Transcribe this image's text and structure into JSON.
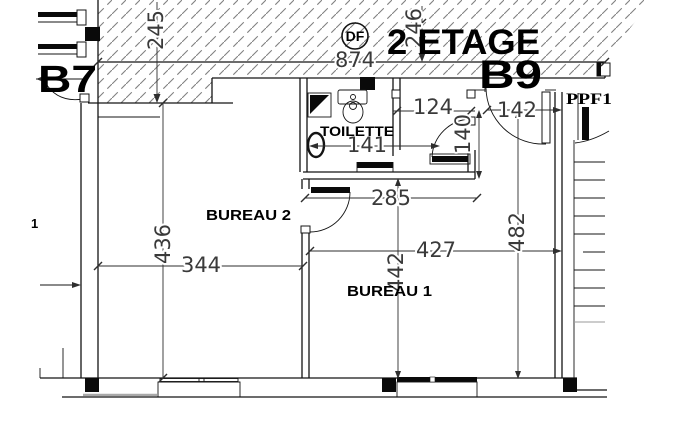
{
  "drawing": {
    "floor_title": "2 ETAGE",
    "zone_left": "B7",
    "zone_right": "B9",
    "smoke_detector": "DF",
    "door_code": "PPF1",
    "marker": "1",
    "rooms": {
      "toilette": "TOILETTE",
      "bureau2": "BUREAU 2",
      "bureau1": "BUREAU 1"
    },
    "dimensions": {
      "d245": "245",
      "d246": "246",
      "d874": "874",
      "d124": "124",
      "d142": "142",
      "d140": "140",
      "d141": "141",
      "d285": "285",
      "d436": "436",
      "d344": "344",
      "d427": "427",
      "d442": "442",
      "d482": "482"
    },
    "colors": {
      "line": "#141414",
      "dim_text": "#3a3a3a",
      "hatch": "#828282"
    }
  }
}
